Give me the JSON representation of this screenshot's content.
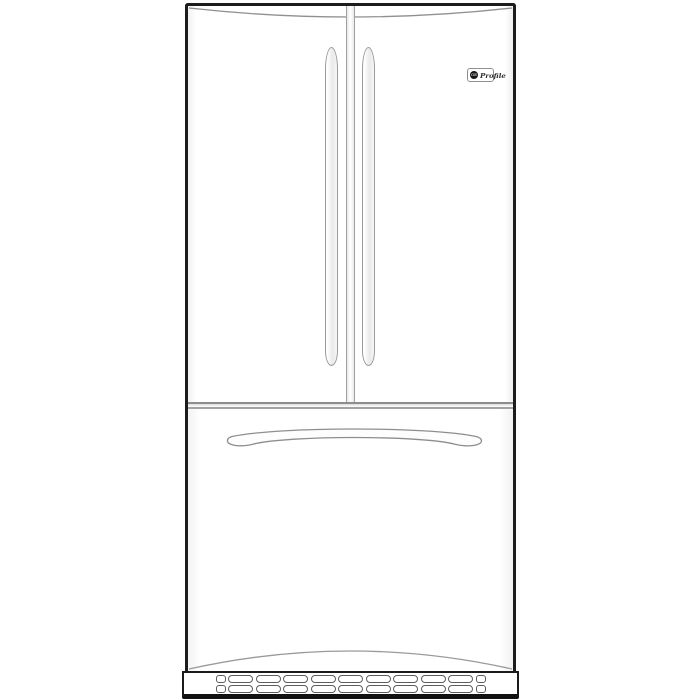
{
  "illustration": {
    "alt": "Front-view line drawing of a stainless french-door refrigerator with bottom freezer drawer",
    "view": "front"
  },
  "brand_badge": {
    "monogram": "GE",
    "line_name": "Profile"
  },
  "colors": {
    "background": "#ffffff",
    "outline_dark": "#1c1c1c",
    "detail_line_gray": "#949494",
    "slot_line_gray": "#5d5d5d",
    "surface_white": "#ffffff",
    "base_band_dark": "#111111"
  },
  "structure": {
    "door_count": 2,
    "door_handle_count": 2,
    "freezer_drawer_count": 1
  },
  "grille": {
    "rows": 2,
    "wide_slots_per_row": 9,
    "small_end_slots_each_side": 1
  }
}
